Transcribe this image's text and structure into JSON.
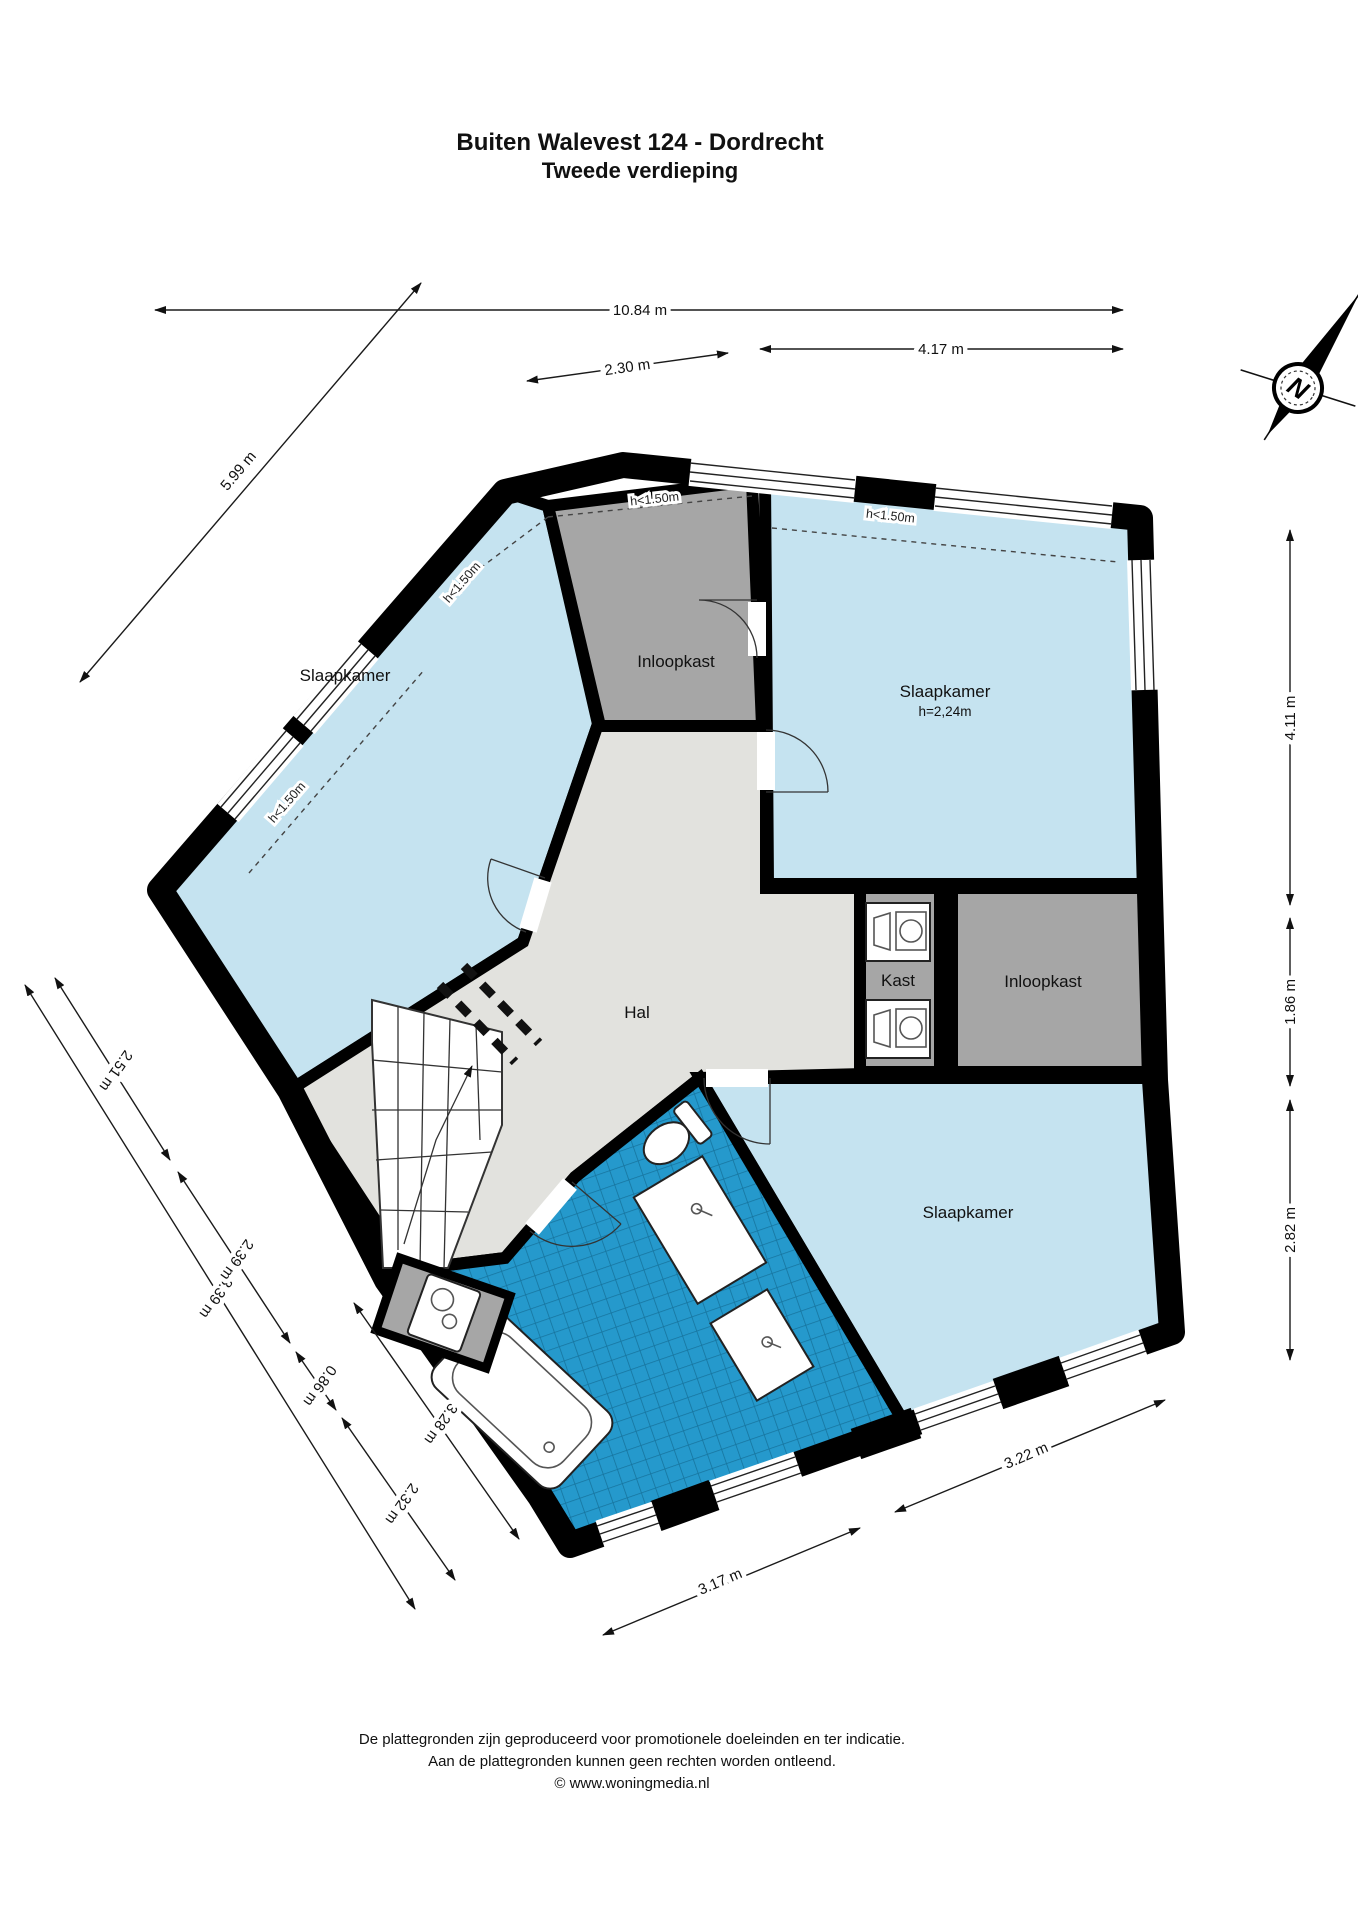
{
  "title": {
    "line1": "Buiten Walevest 124 - Dordrecht",
    "line2": "Tweede verdieping"
  },
  "rooms": {
    "slaapkamer_left": {
      "label": "Slaapkamer"
    },
    "slaapkamer_top_right": {
      "label": "Slaapkamer",
      "height": "h=2,24m"
    },
    "slaapkamer_bottom_right": {
      "label": "Slaapkamer"
    },
    "inloopkast_top": {
      "label": "Inloopkast"
    },
    "inloopkast_right": {
      "label": "Inloopkast"
    },
    "hal": {
      "label": "Hal"
    },
    "kast": {
      "label": "Kast"
    }
  },
  "height_markers": {
    "top_left_lower": "h<1.50m",
    "top_left_upper": "h<1.50m",
    "top_center": "h<1.50m",
    "top_right": "h<1.50m"
  },
  "dimensions": {
    "total_width": "10.84 m",
    "top_small": "2.30 m",
    "top_right": "4.17 m",
    "upper_left_wall": "5.99 m",
    "right_upper": "4.11 m",
    "right_middle": "1.86 m",
    "right_lower": "2.82 m",
    "left_seg1": "2.51 m",
    "left_seg2": "2.39 m",
    "left_seg3": "0.86 m",
    "left_seg4": "2.32 m",
    "left_inner": "3.28 m",
    "left_total": "8.39 m",
    "bottom_left": "3.17 m",
    "bottom_right": "3.22 m"
  },
  "compass": {
    "label": "N"
  },
  "footer": {
    "line1": "De plattegronden zijn geproduceerd voor promotionele doeleinden en ter indicatie.",
    "line2": "Aan de plattegronden kunnen geen rechten worden ontleend.",
    "line3": "© www.woningmedia.nl"
  },
  "colors": {
    "room_blue": "#c5e3f0",
    "closet_gray": "#a6a6a6",
    "hall_gray": "#e2e2de",
    "tile_blue": "#2599cc",
    "tile_grid": "#16749e",
    "wall": "#000000"
  }
}
